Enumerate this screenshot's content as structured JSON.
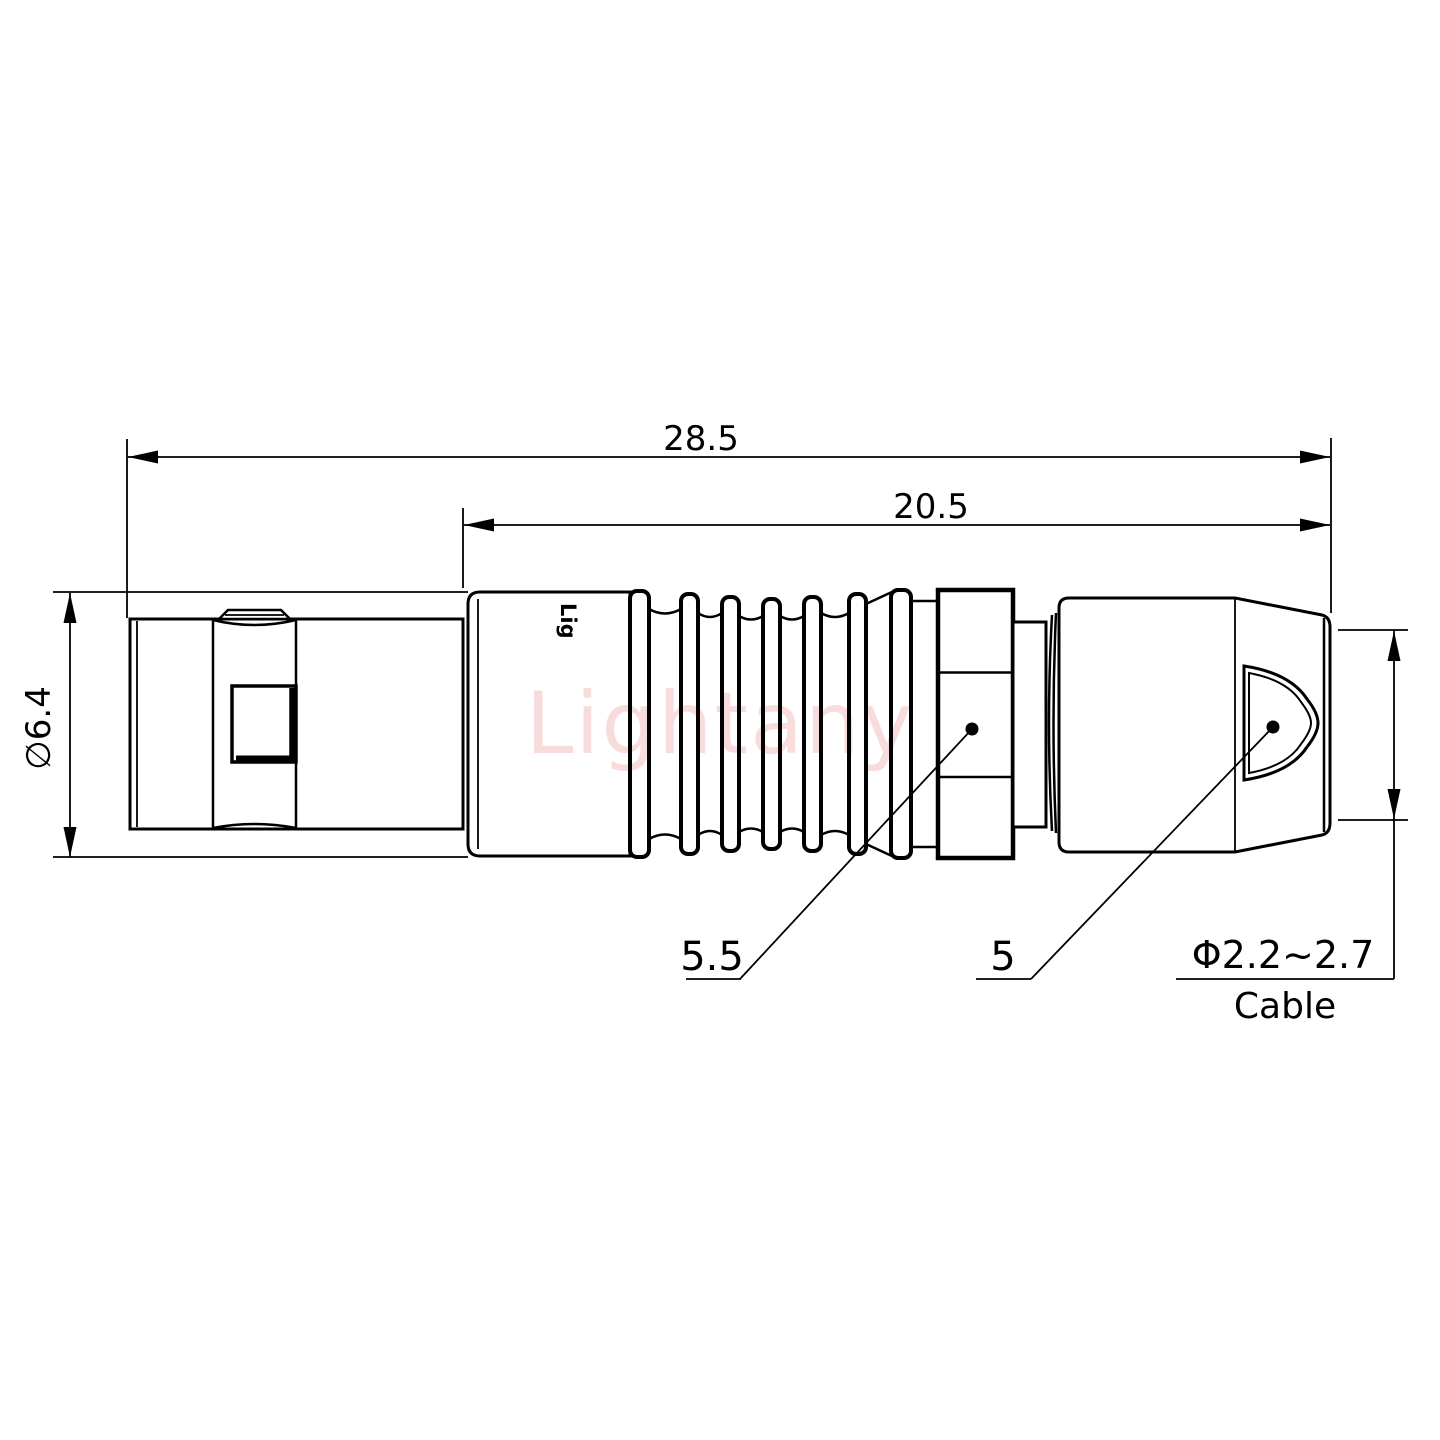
{
  "page": {
    "background": "#ffffff"
  },
  "drawing": {
    "watermark": "Lightany",
    "body_marking": "Lig",
    "line_color": "#000000",
    "watermark_color": "#f2bfbf"
  },
  "dimensions": {
    "overall_length": "28.5",
    "rear_length": "20.5",
    "front_diameter": "∅6.4",
    "nut_flats": "5.5",
    "boot_diameter": "5",
    "cable_range": "Φ2.2~2.7",
    "cable_label": "Cable"
  }
}
